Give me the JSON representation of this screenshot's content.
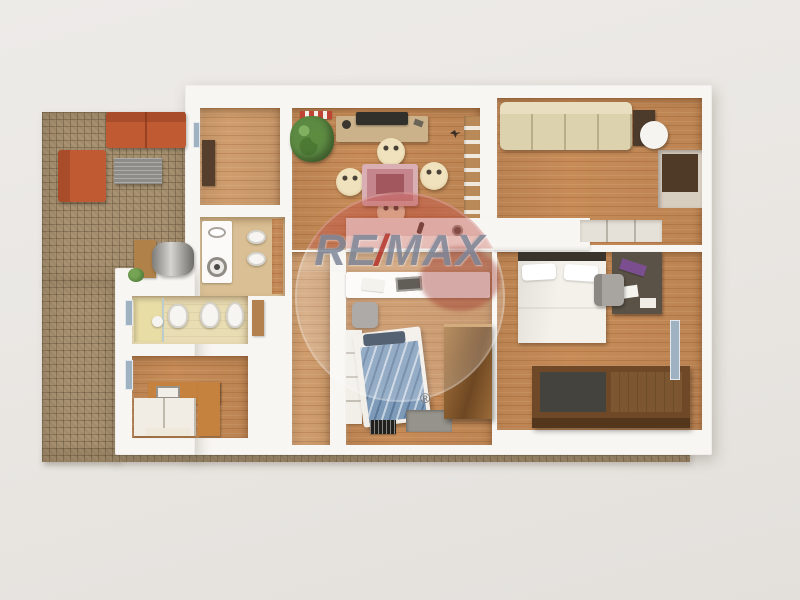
{
  "watermark": {
    "re": "RE",
    "slash": "/",
    "max": "MAX",
    "registered": "®"
  },
  "palette": {
    "background": "#e9e6e2",
    "wall": "#f8f6f2",
    "wood": "#c68b57",
    "wood_light": "#cf9d6d",
    "brick": "#a28c6c",
    "sofa_orange": "#c05a33",
    "sofa_cream": "#ddd2ae",
    "table_pink": "#c5858d",
    "bed_white": "#f4f1ea",
    "bed_blue": "#7d9ab9",
    "counter_orange": "#c5823e",
    "wood_dark": "#553f2c",
    "window_glass": "#9fb2c2",
    "watermark_text": "#7e8799",
    "watermark_red": "#b5372c"
  }
}
